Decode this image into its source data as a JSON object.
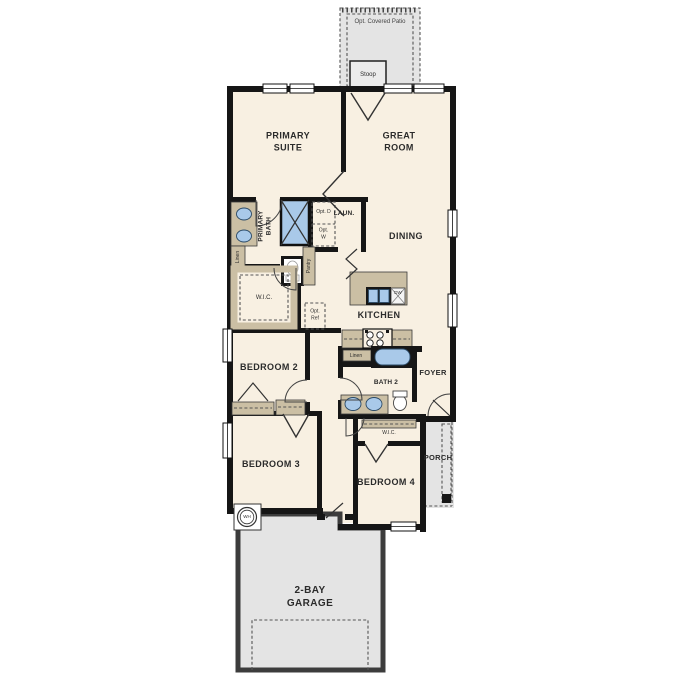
{
  "title": "Single-story floor plan",
  "colors": {
    "floor": "#f8f0e2",
    "wall": "#161616",
    "cabinet_tan": "#cbbfa4",
    "fixture_blue": "#a9c9e9",
    "outdoor_gray": "#e4e4e4",
    "garage_wall": "#3c3c3c",
    "dash": "#555555"
  },
  "labels": {
    "patio": "Opt. Covered Patio",
    "stoop": "Stoop",
    "primary_suite": "PRIMARY SUITE",
    "great_room": "GREAT ROOM",
    "primary_bath": "PRIMARY BATH",
    "linen_primary": "Linen",
    "opt_dryer": "Opt. D",
    "opt_washer": "Opt. W",
    "laundry": "LAUN.",
    "dining": "DINING",
    "pantry": "Pantry",
    "wic_primary": "W.I.C.",
    "opt_ref": "Opt. Ref",
    "kitchen": "KITCHEN",
    "dishwasher": "DW",
    "linen_bath2": "Linen",
    "bath2": "BATH 2",
    "foyer": "FOYER",
    "bedroom2": "BEDROOM 2",
    "bedroom3": "BEDROOM 3",
    "bedroom4": "BEDROOM 4",
    "wic_bedroom4": "W.I.C.",
    "porch": "PORCH",
    "water_heater": "WH",
    "garage": "2-BAY GARAGE"
  }
}
